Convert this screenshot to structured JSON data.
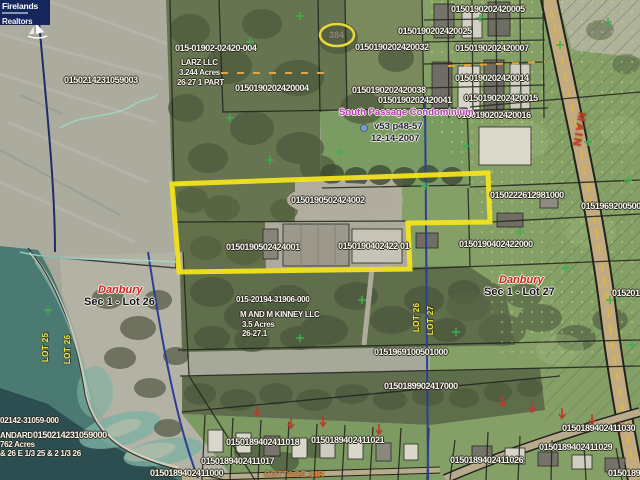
{
  "logo": {
    "title": "Firelands",
    "subtitle": "Realtors"
  },
  "highlight": {
    "color": "#f2e320",
    "shape": "irregular-parcel-outline",
    "oval_value": "384"
  },
  "labels": [
    "0150214231059003",
    "015-01902-02420-004",
    "LARZ LLC",
    "3.244 Acres",
    "26-27 1 PART",
    "0150190202420004",
    "384",
    "0150190202420005",
    "0150190202420025",
    "0150190202420032",
    "0150190202420007",
    "0150190202420014",
    "0150190202420038",
    "0150190202420041",
    "0150190202420015",
    "0150190202420016",
    "South Passage Condominium",
    "v53 p48-57",
    "12-14-2007",
    "0150190502424002",
    "0150190502424001",
    "0150190402422 01",
    "0150190402422000",
    "0150222612981000",
    "0151969200500",
    "MAIN",
    "Danbury",
    "Sec 1 - Lot 26",
    "Danbury",
    "Sec 1 - Lot 27",
    "015201",
    "015-20194-31906-000",
    "M AND M KINNEY LLC",
    "3.5 Acres",
    "26-27.1",
    "LOT 25",
    "LOT 26",
    "LOT 26",
    "LOT 27",
    "0151969100501000",
    "0150189902417000",
    "02142-31059-000",
    "ANDARD",
    "0150214231059000",
    "762 Acres",
    "& 26 E 1/3 25 & 2 1/3 26",
    "0150189402411018",
    "0150189402411021",
    "0150189402411017",
    "0150189402411000",
    "COTTAGE CIR",
    "0150189402411030",
    "0150189402411029",
    "0150189402411026",
    "01501894"
  ]
}
